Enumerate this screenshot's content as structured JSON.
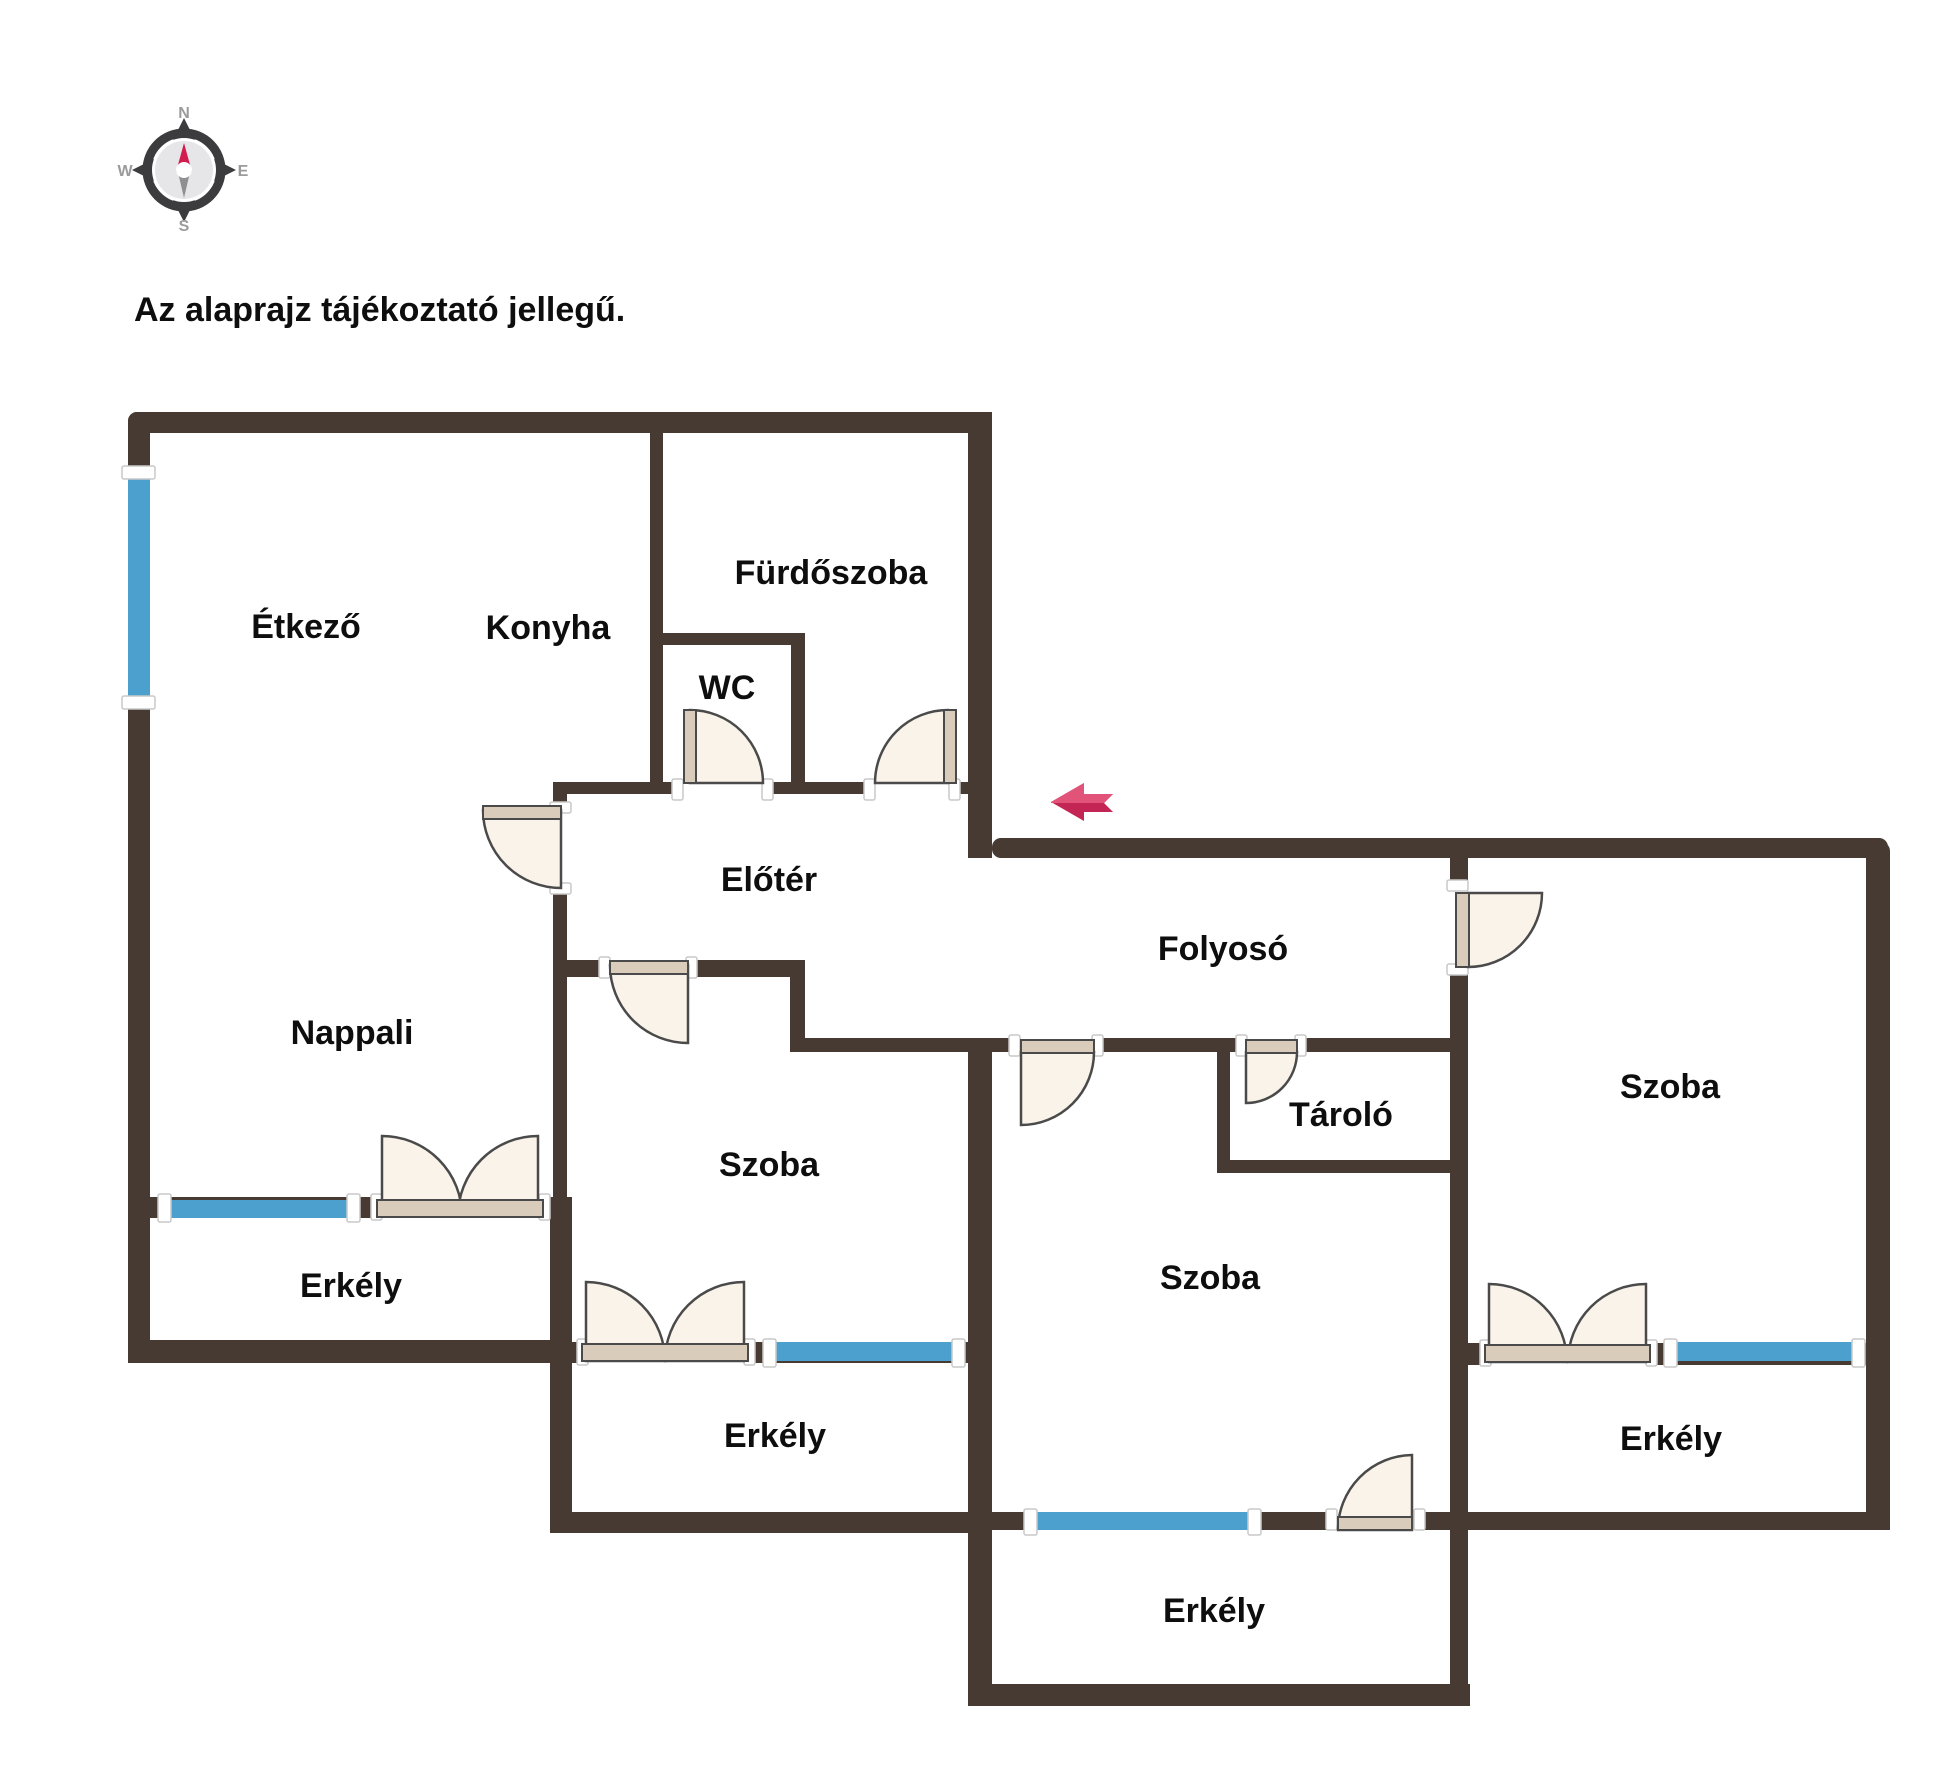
{
  "disclaimer": "Az alaprajz tájékoztató jellegű.",
  "compass": {
    "north": "N",
    "east": "E",
    "south": "S",
    "west": "W"
  },
  "rooms": [
    {
      "name": "Étkező"
    },
    {
      "name": "Konyha"
    },
    {
      "name": "Fürdőszoba"
    },
    {
      "name": "WC"
    },
    {
      "name": "Előtér"
    },
    {
      "name": "Folyosó"
    },
    {
      "name": "Nappali"
    },
    {
      "name": "Szoba"
    },
    {
      "name": "Tároló"
    },
    {
      "name": "Szoba"
    },
    {
      "name": "Szoba"
    },
    {
      "name": "Erkély"
    },
    {
      "name": "Erkély"
    },
    {
      "name": "Erkély"
    },
    {
      "name": "Erkély"
    }
  ],
  "colors": {
    "wall": "#473a32",
    "window": "#4ba0cd",
    "door_fill": "#faf3e9",
    "door_leaf": "#d9ccba",
    "door_outline": "#4a4a4a",
    "jamb_fill": "#ffffff",
    "label": "#0e0e0e",
    "arrow_light": "#e2537a",
    "arrow_dark": "#c32554",
    "compass_ring": "#3c3c3e",
    "compass_inner": "#e6e6e8",
    "compass_text": "#9b9b9d",
    "needle_red": "#d41b4f",
    "needle_gray": "#8f8f92"
  }
}
